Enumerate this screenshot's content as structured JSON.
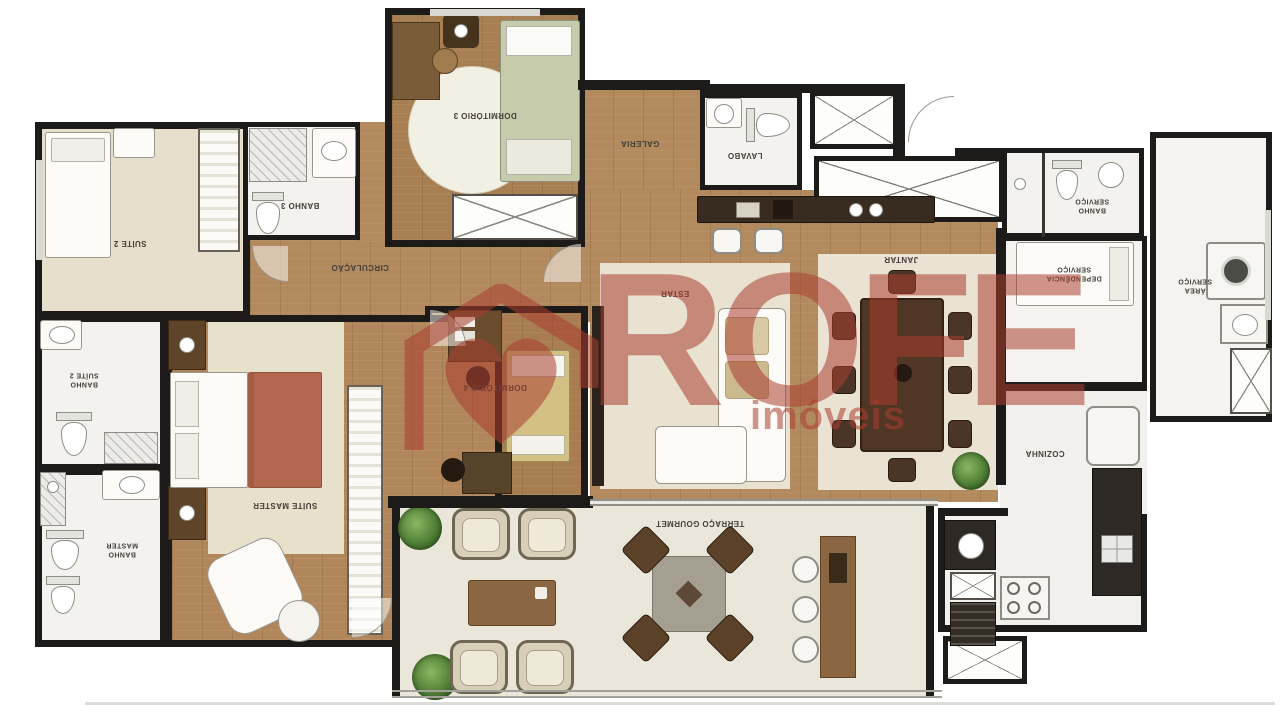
{
  "watermark": {
    "brand": "ROFE",
    "tagline": "imóveis",
    "color": "#AA3E30"
  },
  "palette": {
    "wall": "#1D1B19",
    "wood_floor": "#B28A5E",
    "rug": "#E9E2D1",
    "bath_floor": "#F3F2EE",
    "terrace_floor": "#EAE6D9",
    "accent_bed": "#B4674F"
  },
  "rooms": {
    "suite2": {
      "label": "SUÍTE 2"
    },
    "banho3": {
      "label": "BANHO 3"
    },
    "dormitorio3": {
      "label": "DORMITÓRIO 3"
    },
    "circulacao": {
      "label": "CIRCULAÇÃO"
    },
    "galeria": {
      "label": "GALERIA"
    },
    "lavabo": {
      "label": "LAVABO"
    },
    "estar": {
      "label": "ESTAR"
    },
    "jantar": {
      "label": "JANTAR"
    },
    "banho_servico": {
      "label": "BANHO\nSERVIÇO"
    },
    "dependencia_servico": {
      "label": "DEPENDÊNCIA\nSERVIÇO"
    },
    "area_servico": {
      "label": "ÁREA\nSERVIÇO"
    },
    "cozinha": {
      "label": "COZINHA"
    },
    "dormitorio4": {
      "label": "DORMITÓRIO 4"
    },
    "banho_suite2": {
      "label": "BANHO\nSUÍTE 2"
    },
    "banho_master": {
      "label": "BANHO\nMASTER"
    },
    "suite_master": {
      "label": "SUÍTE MASTER"
    },
    "terraco": {
      "label": "TERRAÇO GOURMET"
    }
  }
}
